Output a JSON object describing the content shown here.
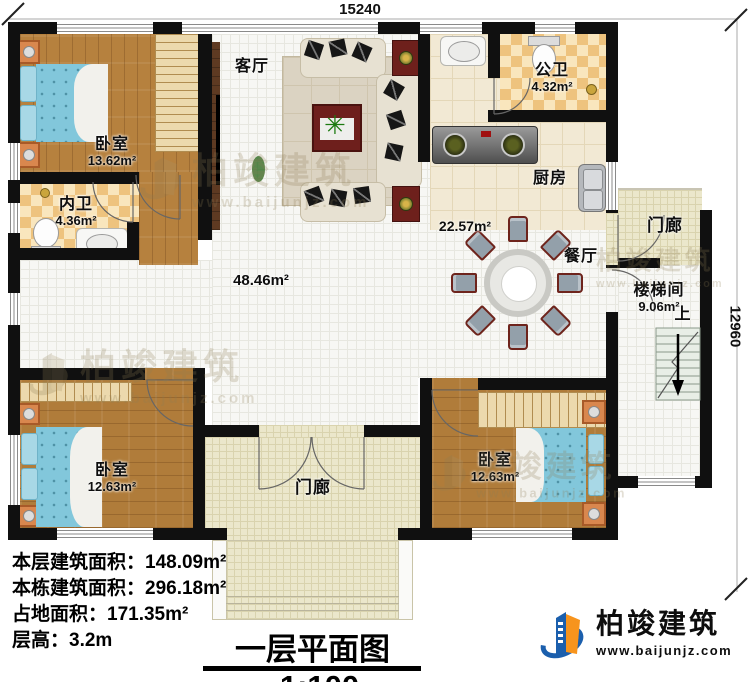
{
  "dimensions": {
    "top": "15240",
    "right": "12960"
  },
  "rooms": {
    "bedroom_tl": {
      "name": "卧室",
      "area": "13.62m²"
    },
    "inner_bath": {
      "name": "内卫",
      "area": "4.36m²"
    },
    "living": {
      "name": "客厅"
    },
    "public_bath": {
      "name": "公卫",
      "area": "4.32m²"
    },
    "kitchen": {
      "name": "厨房",
      "area": "22.57m²"
    },
    "hall": {
      "area": "48.46m²"
    },
    "dining": {
      "name": "餐厅"
    },
    "stairwell": {
      "name": "楼梯间",
      "area": "9.06m²",
      "direction": "上"
    },
    "porch_right": {
      "name": "门廊"
    },
    "porch_bottom": {
      "name": "门廊"
    },
    "bedroom_bl": {
      "name": "卧室",
      "area": "12.63m²"
    },
    "bedroom_br": {
      "name": "卧室",
      "area": "12.63m²"
    }
  },
  "info": {
    "floor_area": "本层建筑面积：148.09m²",
    "total_area": "本栋建筑面积：296.18m²",
    "land_area": "占地面积：171.35m²",
    "floor_height": "层高：3.2m"
  },
  "title": {
    "text": "一层平面图",
    "scale": "1:100"
  },
  "brand": {
    "name": "柏竣建筑",
    "url": "www.baijunjz.com"
  },
  "watermark": {
    "name": "柏竣建筑",
    "url": "www.baijunjz.com"
  },
  "colors": {
    "wall": "#101010",
    "wood_floor": "#b6813e",
    "bathroom_tile": "#eec37e",
    "interior_tile": "#f7f7f4",
    "porch_tile": "#ebe7cb",
    "bed": "#82c7db",
    "brand_blue": "#1b5fad",
    "brand_orange": "#f7941d"
  }
}
